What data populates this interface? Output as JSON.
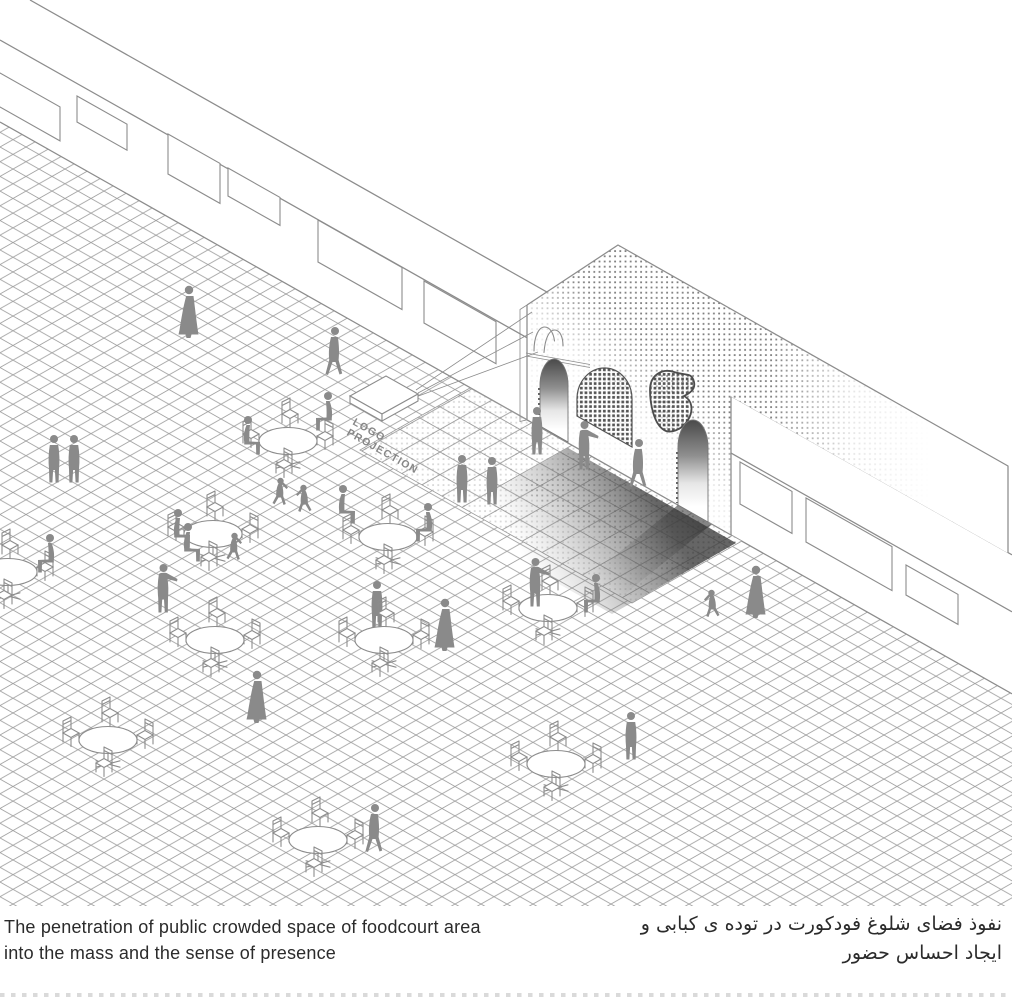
{
  "scene": {
    "description": "Axonometric architectural diagram: crowded foodcourt plaza with round tables, chairs and human silhouettes on an isometric tiled floor, in front of a long bazaar wall; a tall halftone-dotted mass with arched and blob-shaped openings penetrates the wall; a projector box casts a logo onto the mass.",
    "tables": 10,
    "figures": 29,
    "windows": 9,
    "openings": 4
  },
  "drawing": {
    "logo_projection": {
      "line1": "LOGO",
      "line2": "PROJECTION"
    }
  },
  "captions": {
    "english": {
      "line1": "The penetration of public crowded space of foodcourt area",
      "line2": "into the mass and the sense of presence"
    },
    "persian": {
      "line1": "نفوذ فضای شلوغ فودکورت در توده ی کبابی و",
      "line2": "ایجاد احساس حضور"
    }
  },
  "colors": {
    "background": "#ffffff",
    "line": "#8c8c8c",
    "grid_line": "#9e9e9e",
    "silhouette": "#8a8a8a",
    "halftone_dot": "#7f7f7f",
    "shadow_dark": "#404040",
    "caption_text": "#2b2b2b"
  }
}
